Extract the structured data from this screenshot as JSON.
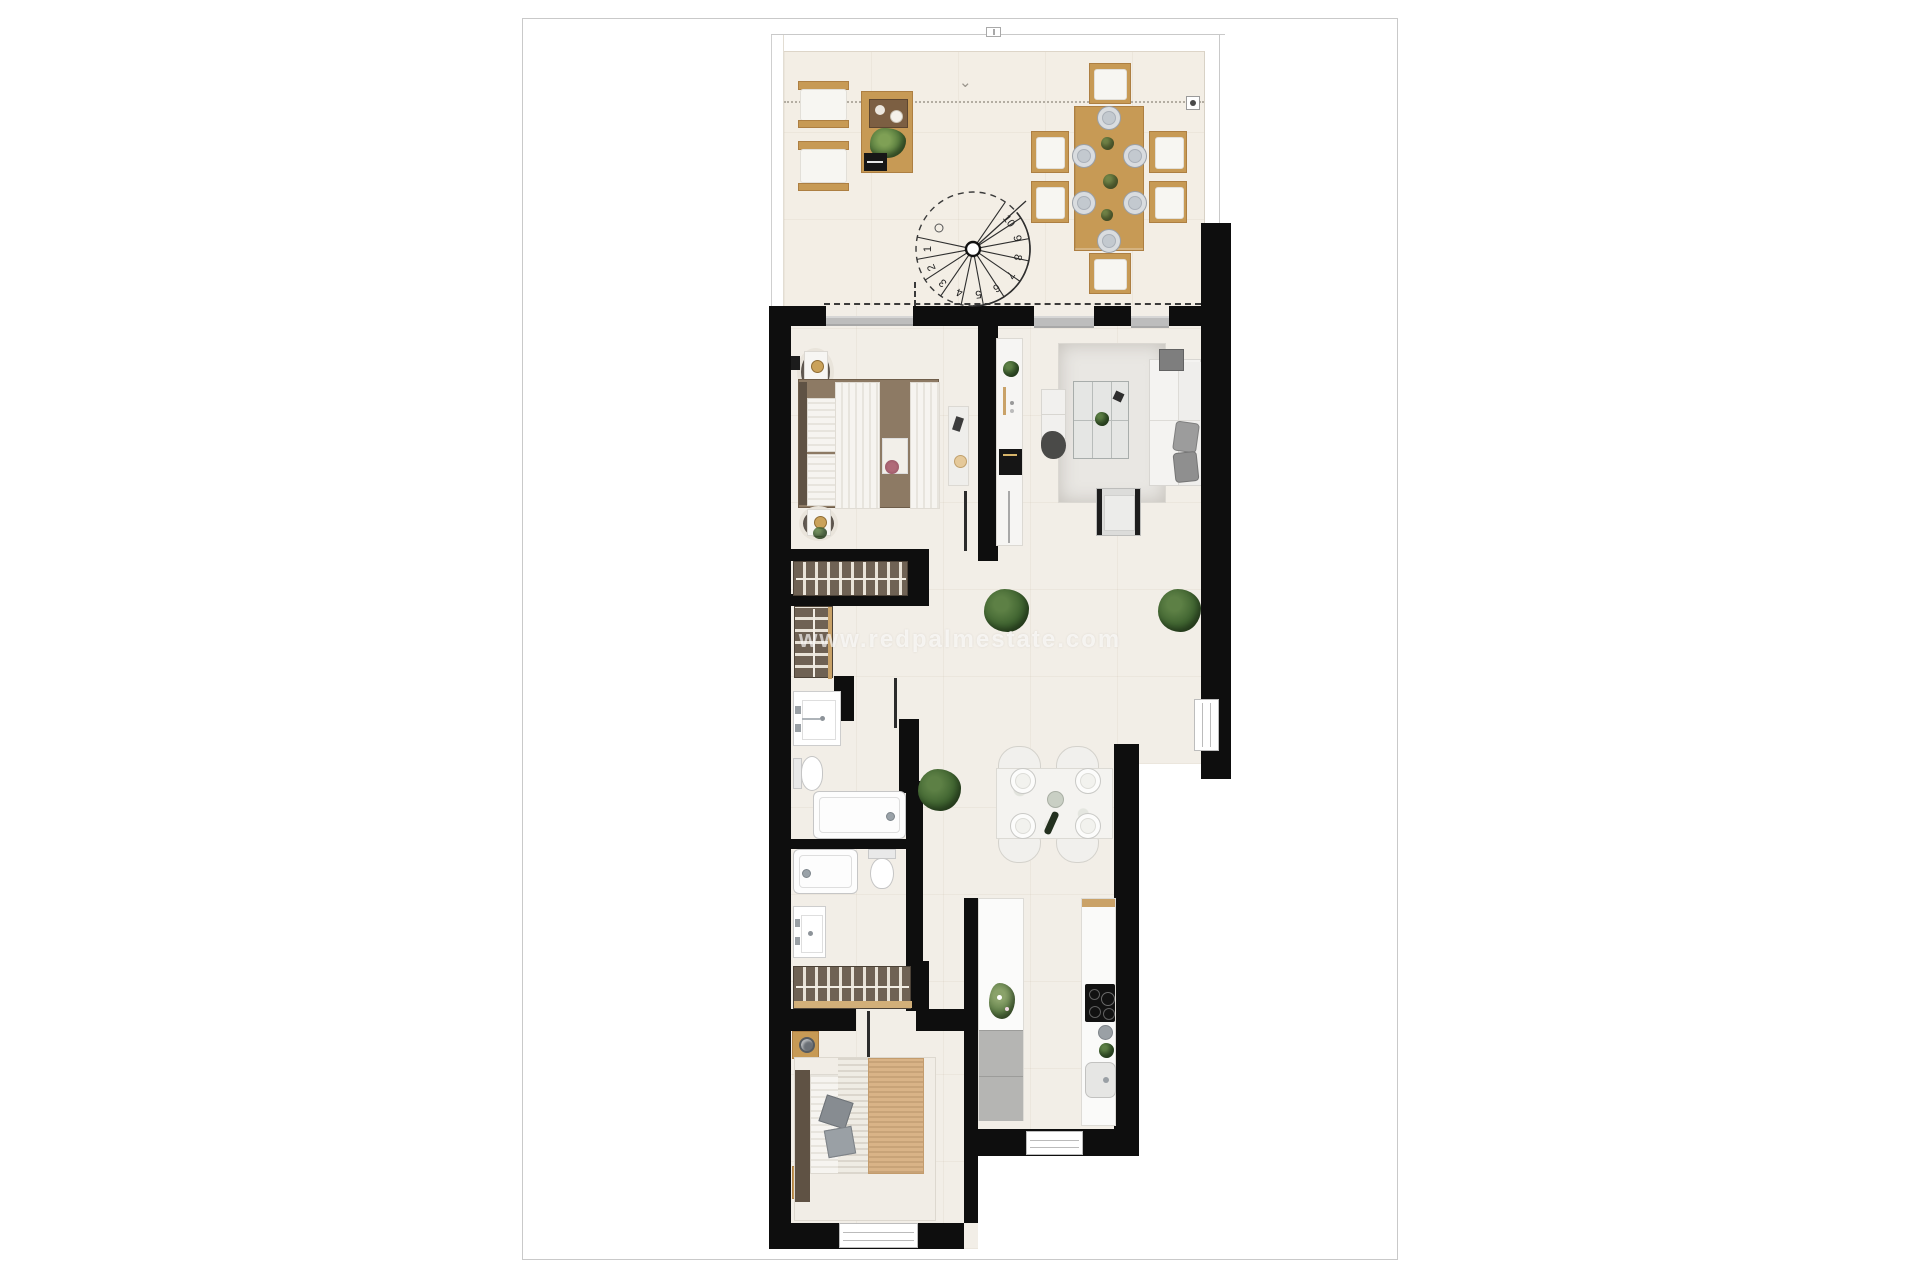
{
  "watermark": {
    "text": "www.redpalmestate.com"
  },
  "stairs": {
    "steps": [
      "1",
      "2",
      "3",
      "4",
      "5",
      "6",
      "7",
      "8",
      "9",
      "10"
    ]
  },
  "colors": {
    "wall": "#0e0e0e",
    "floor_terrace": "#f3eee5",
    "floor_interior": "#f2eee7",
    "wood": "#c79a55",
    "sill": "#bdbdbd",
    "plant": "#3f6330",
    "watermark": "rgba(255,255,255,0.65)"
  },
  "icons": {
    "terrace_arrow": "⌄"
  }
}
